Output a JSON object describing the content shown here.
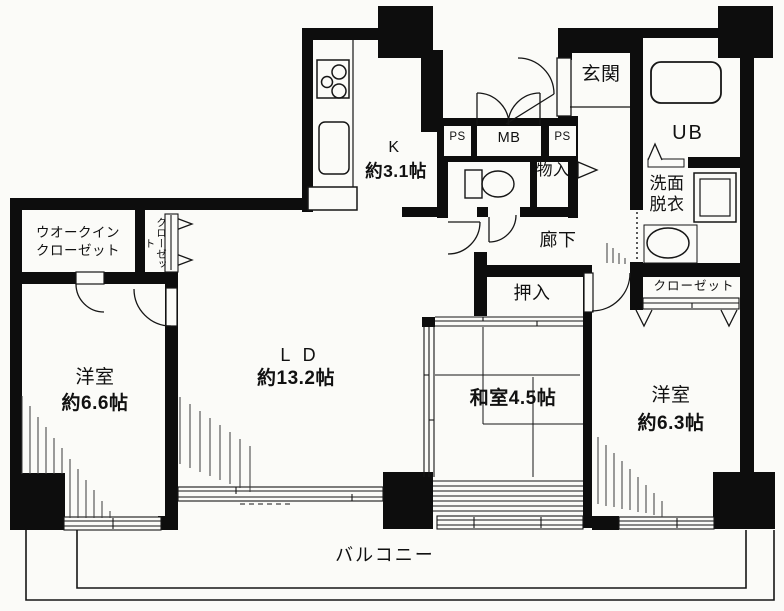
{
  "title": "間取り図",
  "colors": {
    "wall": "#0d0d0d",
    "paper": "#fbfbf8",
    "line": "#161616"
  },
  "rooms": {
    "kitchen": {
      "label": "K",
      "size": "約3.1帖"
    },
    "living_dining": {
      "label": "L D",
      "size": "約13.2帖"
    },
    "western_room_left": {
      "label": "洋室",
      "size": "約6.6帖"
    },
    "western_room_right": {
      "label": "洋室",
      "size": "約6.3帖"
    },
    "japanese_room": {
      "label": "和室4.5帖"
    },
    "entrance": {
      "label": "玄関"
    },
    "unit_bath": {
      "label": "UB"
    },
    "washroom": {
      "label": "洗面\n脱衣"
    },
    "hallway": {
      "label": "廊下"
    },
    "balcony": {
      "label": "バルコニー"
    }
  },
  "storage": {
    "walk_in_closet": {
      "label": "ウオークイン\nクローゼット"
    },
    "closet_column": {
      "label": "クローゼット"
    },
    "closet_right": {
      "label": "クローゼット"
    },
    "oshiire": {
      "label": "押入"
    },
    "mono_ire": {
      "label": "物入"
    }
  },
  "utility": {
    "ps_left": "PS",
    "meter_box": "MB",
    "ps_right": "PS"
  },
  "fixtures": [
    "stove-icon",
    "kitchen-sink-icon",
    "toilet-icon",
    "bathtub-icon",
    "washing-machine-icon",
    "wash-basin-icon"
  ]
}
